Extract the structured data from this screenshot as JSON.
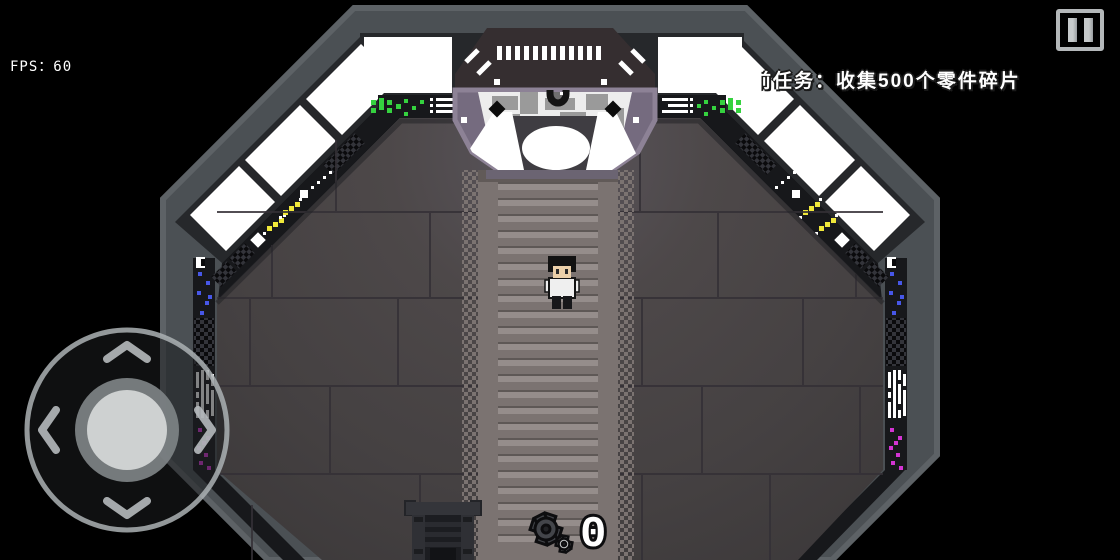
{
  "hud": {
    "fps": {
      "label": "FPS",
      "value": 60,
      "display": "FPS：60"
    },
    "mission": {
      "prefix": "前",
      "text": "任务：收集500个零件碎片"
    },
    "parts_counter": {
      "value": "0",
      "icon": "gear-icon"
    },
    "pause": {
      "icon": "pause-icon"
    },
    "joystick": {
      "icon": "dpad-joystick",
      "directions": [
        "up",
        "down",
        "left",
        "right"
      ]
    }
  },
  "palette": {
    "bg": "#000000",
    "hud-text": "#ffffff",
    "wall-face": "#4b5054",
    "wall-rim": "#5d6266",
    "frame": "#26282b",
    "window": "#ffffff",
    "console": "#17181b",
    "floor-line": "#343036",
    "walkway": "#7b7371",
    "walkway-stripe": "#958d8b",
    "walkway-shadow": "#5e5856",
    "platform": "#756b7f",
    "platform-rim": "#8d8296",
    "hood": "#352e30",
    "light-green": "#35d23f",
    "light-red": "#e23030",
    "light-yellow": "#f0e83a",
    "light-blue": "#4757e8",
    "light-magenta": "#d334d3",
    "skin": "#ecd0a9",
    "shirt": "#efefef",
    "counter-gear": "#43454a",
    "counter-gear-small": "#c9cbcc",
    "joystick-ring": "#acb1b4",
    "knob": "#ced1d1",
    "knob-ring": "#7e8385",
    "chevron": "#b6babd"
  }
}
